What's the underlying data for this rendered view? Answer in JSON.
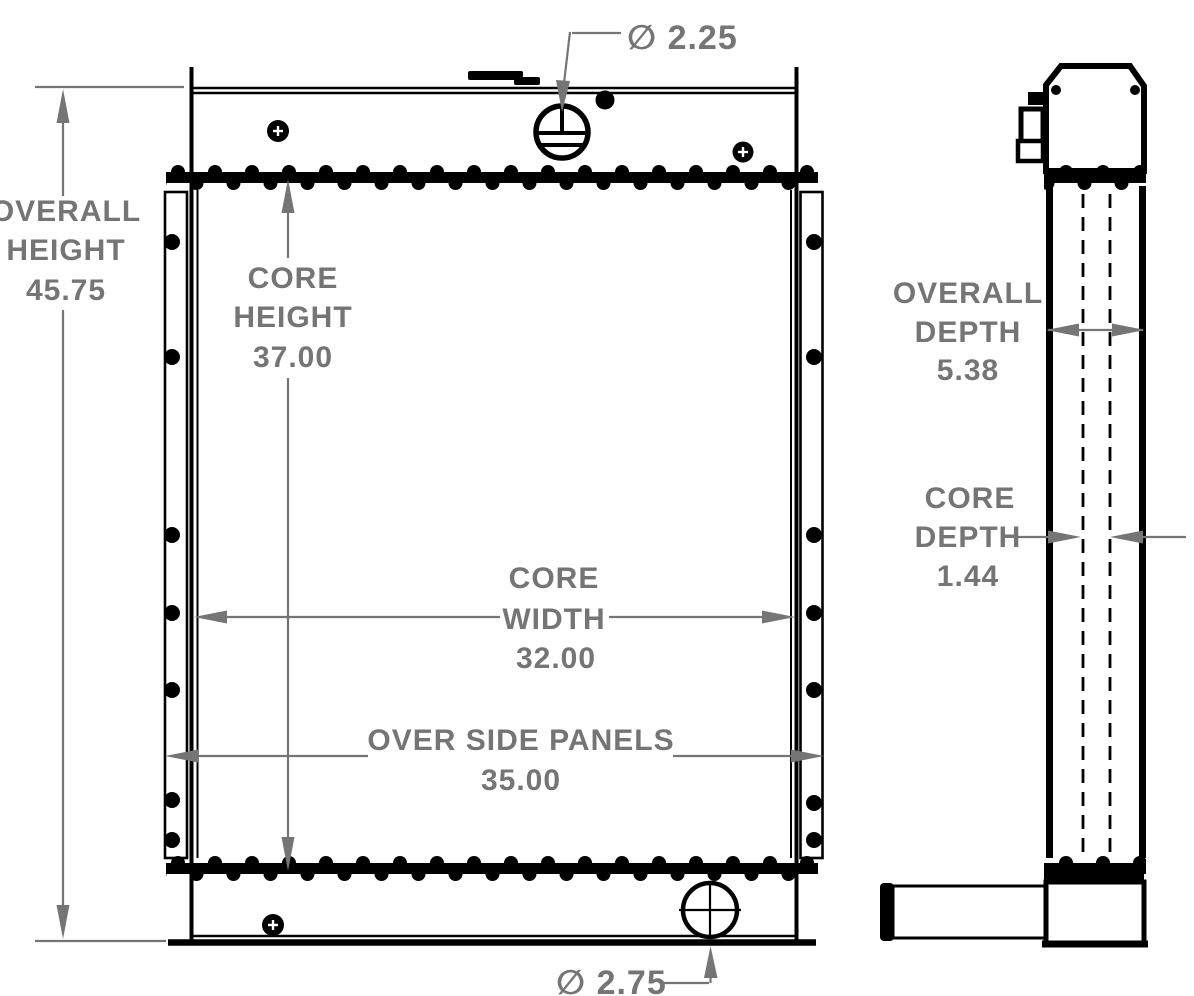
{
  "colors": {
    "part_line": "#000000",
    "dimension": "#757575",
    "background": "#ffffff"
  },
  "labels": {
    "overall_height": [
      "OVERALL",
      "HEIGHT",
      "45.75"
    ],
    "core_height": [
      "CORE",
      "HEIGHT",
      "37.00"
    ],
    "core_width": [
      "CORE",
      "WIDTH",
      "32.00"
    ],
    "over_side_panels": [
      "OVER SIDE PANELS",
      "35.00"
    ],
    "overall_depth": [
      "OVERALL",
      "DEPTH",
      "5.38"
    ],
    "core_depth": [
      "CORE",
      "DEPTH",
      "1.44"
    ],
    "top_port": "∅ 2.25",
    "bottom_port": "∅ 2.75"
  },
  "dimensions": {
    "overall_height": 45.75,
    "core_height": 37.0,
    "core_width": 32.0,
    "over_side_panels": 35.0,
    "overall_depth": 5.38,
    "core_depth": 1.44,
    "top_port_diameter": 2.25,
    "bottom_port_diameter": 2.75
  }
}
